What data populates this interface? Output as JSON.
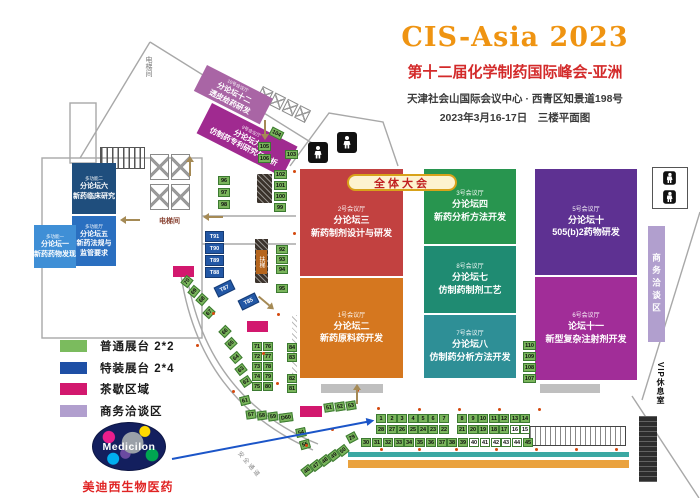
{
  "header": {
    "title": "CIS-Asia 2023",
    "subtitle": "第十二届化学制药国际峰会-亚洲",
    "address": "天津社会山国际会议中心 · 西青区知景道198号",
    "date_line": "2023年3月16-17日　三楼平面图"
  },
  "banner": {
    "plenary": "全体大会"
  },
  "legend": {
    "items": [
      {
        "label": "普通展台 2*2",
        "color": "#7bbb5e"
      },
      {
        "label": "特装展台 2*4",
        "color": "#1e4fa5"
      },
      {
        "label": "茶歇区域",
        "color": "#d2186e"
      },
      {
        "label": "商务洽谈区",
        "color": "#b19fce"
      }
    ]
  },
  "labels": {
    "elevator_hall": "电梯间",
    "elevator_hall_side": "电梯间",
    "escalator": "扶梯",
    "safety_corridor": "安全通道",
    "business_area": "商务洽谈区",
    "vip_lounge": "VIP休息室"
  },
  "sponsor": {
    "logo_text": "Medicilon",
    "company": "美迪西生物医药"
  },
  "plan": {
    "rooms": [
      {
        "id": "hall-2",
        "x": 300,
        "y": 169,
        "w": 103,
        "h": 107,
        "color": "#c24140",
        "lines": [
          "2号会议厅",
          "分论坛三",
          "新药制剂设计与研发"
        ]
      },
      {
        "id": "hall-1",
        "x": 300,
        "y": 278,
        "w": 103,
        "h": 100,
        "color": "#d5771f",
        "lines": [
          "1号会议厅",
          "分论坛二",
          "新药原料药开发"
        ]
      },
      {
        "id": "hall-3",
        "x": 424,
        "y": 169,
        "w": 92,
        "h": 75,
        "color": "#28954f",
        "lines": [
          "3号会议厅",
          "分论坛四",
          "新药分析方法开发"
        ]
      },
      {
        "id": "hall-8",
        "x": 424,
        "y": 246,
        "w": 92,
        "h": 67,
        "color": "#1f8b72",
        "lines": [
          "8号会议厅",
          "分论坛七",
          "仿制药制剂工艺"
        ]
      },
      {
        "id": "hall-7",
        "x": 424,
        "y": 315,
        "w": 92,
        "h": 63,
        "color": "#2e8f96",
        "lines": [
          "7号会议厅",
          "分论坛八",
          "仿制药分析方法开发"
        ]
      },
      {
        "id": "hall-5",
        "x": 535,
        "y": 169,
        "w": 102,
        "h": 106,
        "color": "#5e3192",
        "lines": [
          "5号会议厅",
          "分论坛十",
          "505(b)2药物研发"
        ]
      },
      {
        "id": "hall-6",
        "x": 535,
        "y": 277,
        "w": 102,
        "h": 103,
        "color": "#a12d98",
        "lines": [
          "6号会议厅",
          "论坛十一",
          "新型复杂注射剂开发"
        ]
      },
      {
        "id": "multi-2",
        "cls": "small",
        "x": 72,
        "y": 163,
        "w": 44,
        "h": 51,
        "color": "#1f4e7d",
        "lines": [
          "多功能二",
          "分论坛六",
          "新药临床研究"
        ]
      },
      {
        "id": "multi-5",
        "cls": "small",
        "x": 72,
        "y": 216,
        "w": 44,
        "h": 50,
        "color": "#2a6fc0",
        "lines": [
          "多功能厅",
          "分论坛五",
          "新药法规与",
          "监管要求"
        ]
      },
      {
        "id": "multi-1",
        "cls": "small",
        "x": 34,
        "y": 225,
        "w": 42,
        "h": 43,
        "color": "#3f8fd6",
        "lines": [
          "多功能一",
          "分论坛一",
          "新药药物发现"
        ]
      },
      {
        "id": "hall-10",
        "cls": "tiny",
        "x": 207,
        "y": 65,
        "w": 74,
        "h": 29,
        "rot": 27,
        "color": "#a965a5",
        "lines": [
          "10号会议厅",
          "分论坛十二",
          "透皮给药研发"
        ]
      },
      {
        "id": "hall-9",
        "cls": "tiny",
        "x": 212,
        "y": 103,
        "w": 96,
        "h": 34,
        "rot": 27,
        "color": "#a02a90",
        "lines": [
          "9号会议厅",
          "分论坛九",
          "仿制药专利研究与分析"
        ]
      }
    ],
    "booths": [
      {
        "n": "1",
        "x": 376,
        "y": 414
      },
      {
        "n": "2",
        "x": 387,
        "y": 414
      },
      {
        "n": "3",
        "x": 397,
        "y": 414
      },
      {
        "n": "4",
        "x": 408,
        "y": 414
      },
      {
        "n": "5",
        "x": 418,
        "y": 414
      },
      {
        "n": "6",
        "x": 428,
        "y": 414
      },
      {
        "n": "7",
        "x": 439,
        "y": 414
      },
      {
        "n": "8",
        "x": 457,
        "y": 414
      },
      {
        "n": "9",
        "x": 468,
        "y": 414
      },
      {
        "n": "10",
        "x": 478,
        "y": 414
      },
      {
        "n": "11",
        "x": 489,
        "y": 414
      },
      {
        "n": "12",
        "x": 499,
        "y": 414
      },
      {
        "n": "13",
        "x": 510,
        "y": 414
      },
      {
        "n": "14",
        "x": 520,
        "y": 414
      },
      {
        "n": "28",
        "x": 376,
        "y": 425
      },
      {
        "n": "27",
        "x": 387,
        "y": 425
      },
      {
        "n": "26",
        "x": 397,
        "y": 425
      },
      {
        "n": "25",
        "x": 408,
        "y": 425
      },
      {
        "n": "24",
        "x": 418,
        "y": 425
      },
      {
        "n": "23",
        "x": 428,
        "y": 425
      },
      {
        "n": "22",
        "x": 439,
        "y": 425
      },
      {
        "n": "21",
        "x": 457,
        "y": 425
      },
      {
        "n": "20",
        "x": 468,
        "y": 425
      },
      {
        "n": "19",
        "x": 478,
        "y": 425
      },
      {
        "n": "18",
        "x": 489,
        "y": 425
      },
      {
        "n": "17",
        "x": 499,
        "y": 425
      },
      {
        "n": "16",
        "x": 510,
        "y": 425,
        "f": "w"
      },
      {
        "n": "15",
        "x": 520,
        "y": 425,
        "f": "w"
      },
      {
        "n": "30",
        "x": 361,
        "y": 438
      },
      {
        "n": "31",
        "x": 372,
        "y": 438
      },
      {
        "n": "32",
        "x": 383,
        "y": 438
      },
      {
        "n": "33",
        "x": 394,
        "y": 438
      },
      {
        "n": "34",
        "x": 404,
        "y": 438
      },
      {
        "n": "35",
        "x": 415,
        "y": 438
      },
      {
        "n": "36",
        "x": 426,
        "y": 438
      },
      {
        "n": "37",
        "x": 437,
        "y": 438
      },
      {
        "n": "38",
        "x": 447,
        "y": 438
      },
      {
        "n": "39",
        "x": 458,
        "y": 438
      },
      {
        "n": "40",
        "x": 469,
        "y": 438,
        "f": "w"
      },
      {
        "n": "41",
        "x": 480,
        "y": 438,
        "f": "w"
      },
      {
        "n": "42",
        "x": 491,
        "y": 438,
        "f": "w"
      },
      {
        "n": "43",
        "x": 501,
        "y": 438,
        "f": "w"
      },
      {
        "n": "44",
        "x": 512,
        "y": 438,
        "f": "w"
      },
      {
        "n": "45",
        "x": 523,
        "y": 438
      },
      {
        "n": "29",
        "x": 347,
        "y": 433,
        "r": -28
      },
      {
        "n": "51",
        "x": 324,
        "y": 403,
        "r": -10
      },
      {
        "n": "52",
        "x": 335,
        "y": 402,
        "r": -10
      },
      {
        "n": "53",
        "x": 346,
        "y": 401,
        "r": -10
      },
      {
        "n": "54",
        "x": 296,
        "y": 428,
        "r": -12
      },
      {
        "n": "55",
        "x": 300,
        "y": 440,
        "r": -16
      },
      {
        "n": "57",
        "x": 246,
        "y": 410,
        "r": -8
      },
      {
        "n": "58",
        "x": 257,
        "y": 411,
        "r": -8
      },
      {
        "n": "59",
        "x": 268,
        "y": 412,
        "r": -8
      },
      {
        "n": "D60",
        "x": 279,
        "y": 413,
        "r": -8,
        "w": 14
      },
      {
        "n": "61",
        "x": 240,
        "y": 396,
        "r": -14
      },
      {
        "n": "62",
        "x": 241,
        "y": 377,
        "r": -34
      },
      {
        "n": "63",
        "x": 236,
        "y": 365,
        "r": -38
      },
      {
        "n": "64",
        "x": 231,
        "y": 353,
        "r": -41
      },
      {
        "n": "65",
        "x": 226,
        "y": 339,
        "r": -43
      },
      {
        "n": "66",
        "x": 220,
        "y": 327,
        "r": -45
      },
      {
        "n": "67",
        "x": 204,
        "y": 308,
        "r": -47
      },
      {
        "n": "68",
        "x": 197,
        "y": 295,
        "r": -48
      },
      {
        "n": "69",
        "x": 189,
        "y": 287,
        "r": -50
      },
      {
        "n": "70",
        "x": 182,
        "y": 277,
        "r": -52
      },
      {
        "n": "71",
        "x": 252,
        "y": 342
      },
      {
        "n": "76",
        "x": 263,
        "y": 342
      },
      {
        "n": "72",
        "x": 252,
        "y": 352
      },
      {
        "n": "77",
        "x": 263,
        "y": 352
      },
      {
        "n": "73",
        "x": 252,
        "y": 362
      },
      {
        "n": "78",
        "x": 263,
        "y": 362
      },
      {
        "n": "74",
        "x": 252,
        "y": 372
      },
      {
        "n": "79",
        "x": 263,
        "y": 372
      },
      {
        "n": "75",
        "x": 252,
        "y": 382
      },
      {
        "n": "80",
        "x": 263,
        "y": 382
      },
      {
        "n": "81",
        "x": 287,
        "y": 384
      },
      {
        "n": "82",
        "x": 287,
        "y": 374
      },
      {
        "n": "83",
        "x": 287,
        "y": 353
      },
      {
        "n": "84",
        "x": 287,
        "y": 343
      },
      {
        "n": "46",
        "x": 302,
        "y": 466,
        "r": -38
      },
      {
        "n": "47",
        "x": 311,
        "y": 461,
        "r": -38
      },
      {
        "n": "48",
        "x": 320,
        "y": 456,
        "r": -38
      },
      {
        "n": "49",
        "x": 329,
        "y": 451,
        "r": -38
      },
      {
        "n": "50",
        "x": 338,
        "y": 446,
        "r": -38
      },
      {
        "n": "92",
        "x": 276,
        "y": 245,
        "w": 12
      },
      {
        "n": "93",
        "x": 276,
        "y": 255,
        "w": 12
      },
      {
        "n": "94",
        "x": 276,
        "y": 265,
        "w": 12
      },
      {
        "n": "95",
        "x": 276,
        "y": 284,
        "w": 12
      },
      {
        "n": "96",
        "x": 218,
        "y": 176,
        "w": 12
      },
      {
        "n": "97",
        "x": 218,
        "y": 188,
        "w": 12
      },
      {
        "n": "98",
        "x": 218,
        "y": 200,
        "w": 12
      },
      {
        "n": "99",
        "x": 274,
        "y": 203,
        "w": 12
      },
      {
        "n": "100",
        "x": 274,
        "y": 192,
        "w": 13
      },
      {
        "n": "101",
        "x": 274,
        "y": 181,
        "w": 13
      },
      {
        "n": "102",
        "x": 274,
        "y": 170,
        "w": 13
      },
      {
        "n": "103",
        "x": 285,
        "y": 150,
        "w": 13
      },
      {
        "n": "104",
        "x": 270,
        "y": 129,
        "w": 13,
        "r": 27
      },
      {
        "n": "105",
        "x": 258,
        "y": 142,
        "w": 13
      },
      {
        "n": "106",
        "x": 258,
        "y": 154,
        "w": 13
      },
      {
        "n": "107",
        "x": 523,
        "y": 374,
        "w": 13
      },
      {
        "n": "108",
        "x": 523,
        "y": 363,
        "w": 13
      },
      {
        "n": "109",
        "x": 523,
        "y": 352,
        "w": 13
      },
      {
        "n": "110",
        "x": 523,
        "y": 341,
        "w": 13
      }
    ],
    "special_booths": [
      {
        "n": "T91",
        "x": 205,
        "y": 231
      },
      {
        "n": "T90",
        "x": 205,
        "y": 243
      },
      {
        "n": "T89",
        "x": 205,
        "y": 255
      },
      {
        "n": "T88",
        "x": 205,
        "y": 267
      },
      {
        "n": "T87",
        "x": 215,
        "y": 283,
        "r": -26
      },
      {
        "n": "T85",
        "x": 239,
        "y": 296,
        "r": -26
      }
    ],
    "tea_breaks": [
      [
        173,
        266,
        21,
        11
      ],
      [
        247,
        321,
        21,
        11
      ],
      [
        300,
        406,
        22,
        11
      ]
    ],
    "gray_bars": [
      [
        321,
        384,
        62,
        9
      ],
      [
        540,
        384,
        60,
        9
      ]
    ],
    "dots": [
      [
        212,
        312
      ],
      [
        277,
        313
      ],
      [
        262,
        352
      ],
      [
        276,
        382
      ],
      [
        232,
        390
      ],
      [
        196,
        344
      ],
      [
        305,
        444
      ],
      [
        331,
        428
      ],
      [
        356,
        389
      ],
      [
        377,
        407
      ],
      [
        418,
        408
      ],
      [
        458,
        408
      ],
      [
        498,
        408
      ],
      [
        538,
        408
      ],
      [
        380,
        448
      ],
      [
        418,
        448
      ],
      [
        455,
        448
      ],
      [
        495,
        448
      ],
      [
        535,
        448
      ],
      [
        575,
        448
      ],
      [
        615,
        448
      ],
      [
        293,
        232
      ],
      [
        293,
        170
      ]
    ]
  }
}
